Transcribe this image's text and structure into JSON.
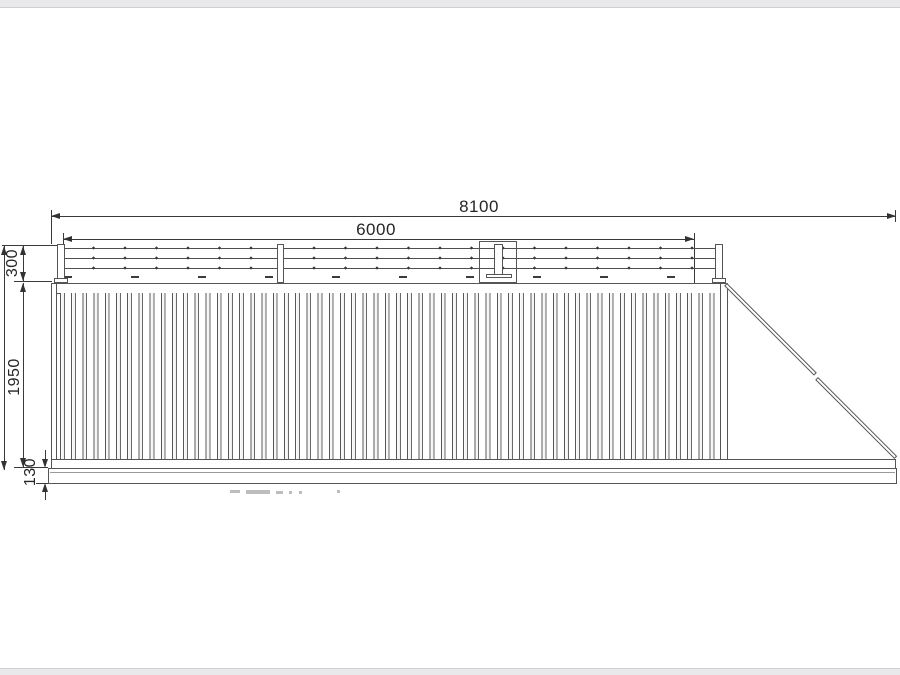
{
  "page": {
    "background": "#ffffff",
    "chrome_strip_color": "#e9e9eb"
  },
  "drawing": {
    "type": "technical-drawing",
    "subject": "cantilever sliding gate elevation with barbed-wire top guard",
    "line_color": "#4f4f4f",
    "dim_text_color": "#262626",
    "dimensions": {
      "overall_width": "8100",
      "leaf_width": "6000",
      "top_guard_height": "300",
      "leaf_height": "1950",
      "bottom_beam_height": "130",
      "overall_height_clipped": "2380"
    }
  }
}
